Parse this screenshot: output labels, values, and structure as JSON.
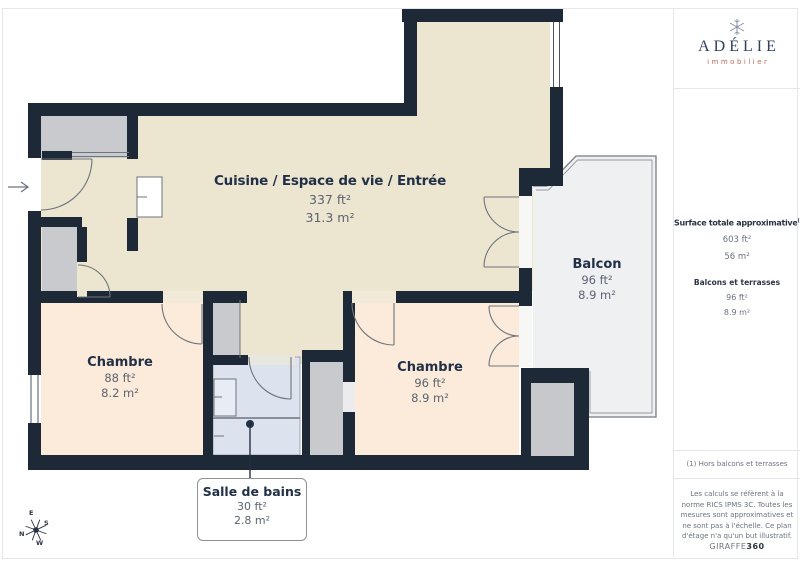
{
  "plan": {
    "rooms": {
      "main": {
        "name": "Cuisine / Espace de vie / Entrée",
        "ft": "337 ft²",
        "m2": "31.3 m²"
      },
      "balcony": {
        "name": "Balcon",
        "ft": "96 ft²",
        "m2": "8.9 m²"
      },
      "bedroom1": {
        "name": "Chambre",
        "ft": "88 ft²",
        "m2": "8.2 m²"
      },
      "bedroom2": {
        "name": "Chambre",
        "ft": "96 ft²",
        "m2": "8.9 m²"
      },
      "bathroom": {
        "name": "Salle de bains",
        "ft": "30 ft²",
        "m2": "2.8 m²"
      }
    },
    "compass": {
      "n": "N",
      "e": "E",
      "s": "S",
      "w": "W"
    }
  },
  "sidebar": {
    "logo": {
      "brand": "ADÉLIE",
      "subtitle": "immobilier",
      "icon": "snowflake-icon"
    },
    "surface": {
      "title": "Surface totale approximative",
      "superscript": "(1)",
      "total_ft": "603 ft²",
      "total_m2": "56 m²",
      "balcony_label": "Balcons et terrasses",
      "balcony_ft": "96 ft²",
      "balcony_m2": "8.9 m²"
    },
    "footnote": "(1) Hors balcons et terrasses",
    "disclaimer": "Les calculs se réfèrent à la norme RICS IPMS 3C. Toutes les mesures sont approximatives et ne sont pas à l'échelle. Ce plan d'étage n'a qu'un but illustratif.",
    "brand_footer": {
      "name": "GIRAFFE",
      "suffix": "360"
    }
  },
  "colors": {
    "wall": "#1e2937",
    "main_room": "#ece5d0",
    "bedroom": "#fcebdb",
    "bathroom": "#dde3ee",
    "closet": "#c8cacd",
    "balcony": "#eff0f2",
    "accent_text": "#223047",
    "brand_red": "#c4685c",
    "brand_navy": "#31405e"
  }
}
